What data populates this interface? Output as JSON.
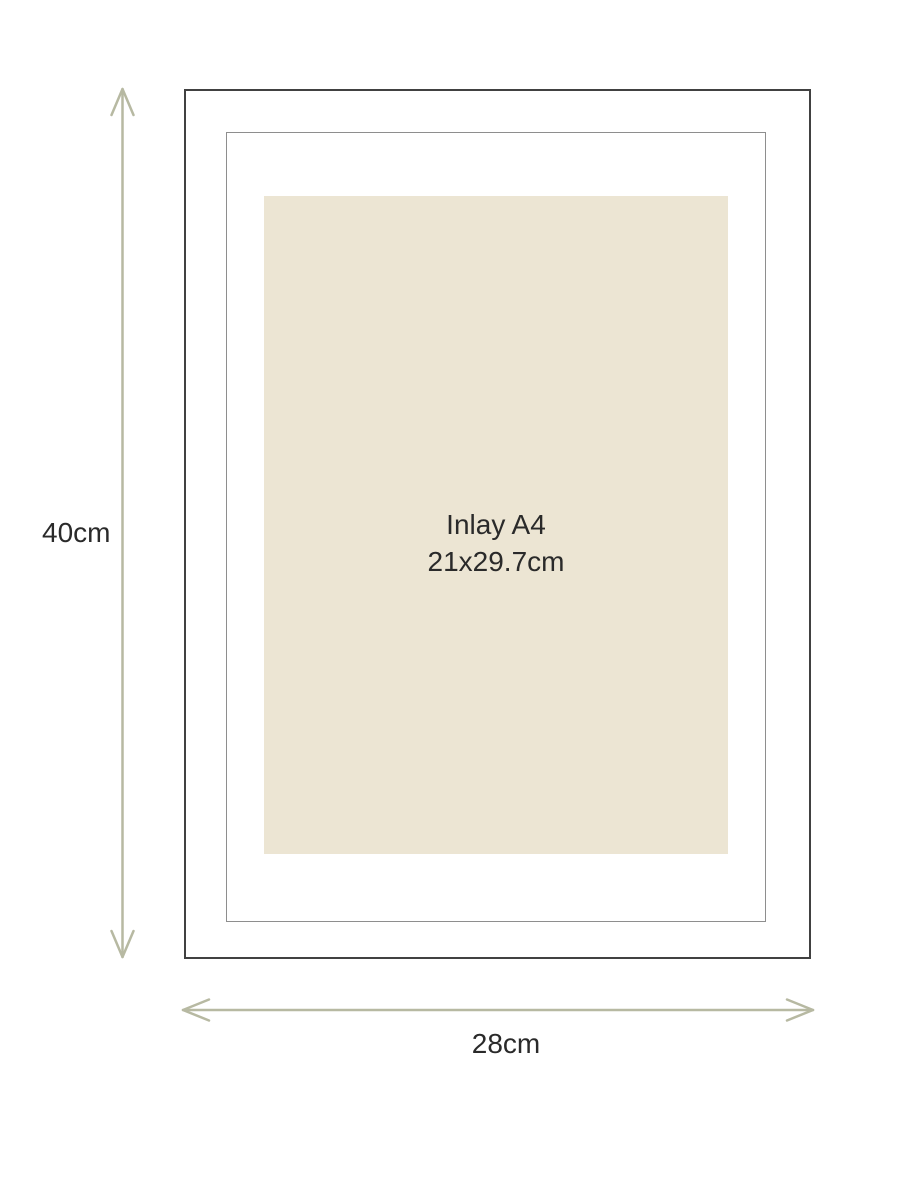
{
  "diagram": {
    "height_label": "40cm",
    "width_label": "28cm",
    "inlay": {
      "title": "Inlay A4",
      "size": "21x29.7cm"
    },
    "colors": {
      "background": "#ffffff",
      "arrow": "#b7b9a2",
      "outer_border": "#414141",
      "inner_border": "#8e8e8e",
      "inlay_fill": "#ece5d3",
      "text": "#2a2a2a"
    }
  }
}
